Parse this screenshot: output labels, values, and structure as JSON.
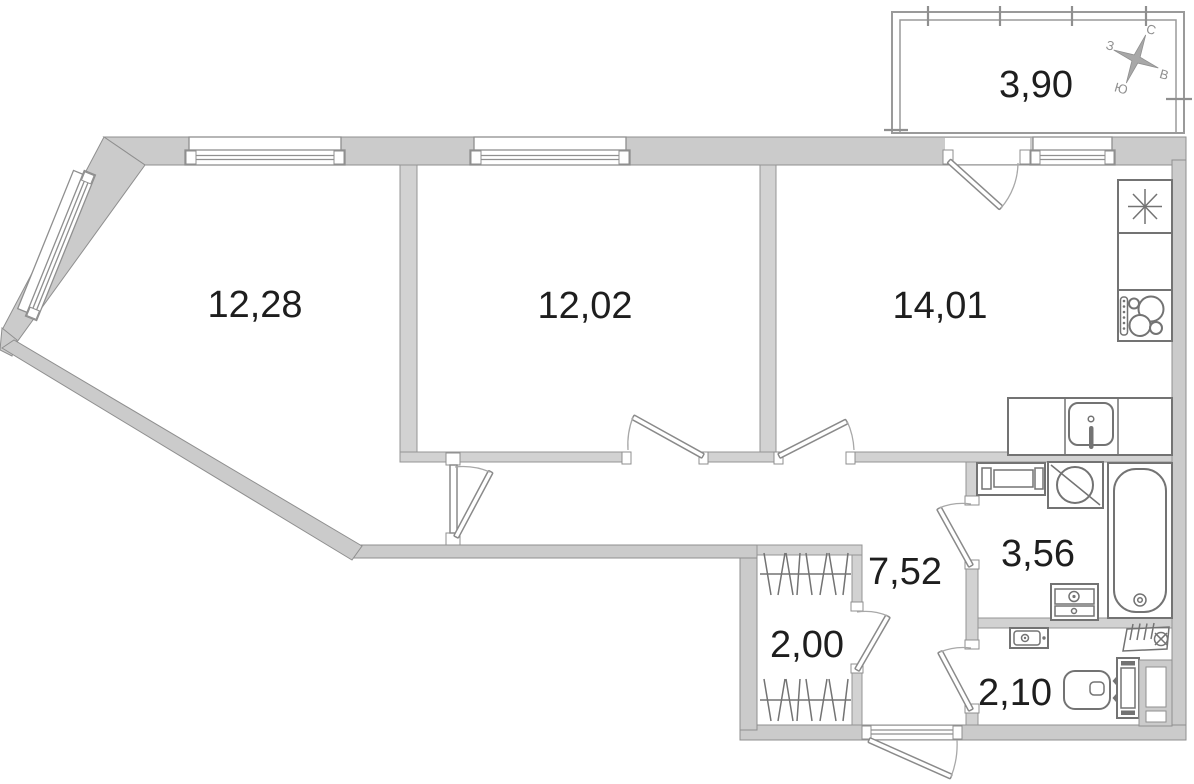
{
  "plan": {
    "rooms": {
      "living": {
        "name": "living-room",
        "area": "12,28"
      },
      "bedroom": {
        "name": "bedroom",
        "area": "12,02"
      },
      "kitchen": {
        "name": "kitchen",
        "area": "14,01"
      },
      "balcony": {
        "name": "balcony",
        "area": "3,90"
      },
      "hallway": {
        "name": "hallway",
        "area": "7,52"
      },
      "bathroom": {
        "name": "bathroom",
        "area": "3,56"
      },
      "closet": {
        "name": "closet",
        "area": "2,00"
      },
      "wc": {
        "name": "wc",
        "area": "2,10"
      }
    },
    "compass": {
      "north": "С",
      "south": "Ю",
      "west": "З",
      "east": "В"
    },
    "fixtures": [
      "fridge",
      "stove",
      "kitchen-sink",
      "bathtub",
      "washing-machine",
      "vanity",
      "wc-sink",
      "toilet",
      "vent",
      "wardrobe"
    ],
    "colors": {
      "wall_fill": "#cbcbcb",
      "wall_stroke": "#8f8f8f",
      "fixture_stroke": "#737373",
      "label_color": "#1e1e1e"
    }
  }
}
